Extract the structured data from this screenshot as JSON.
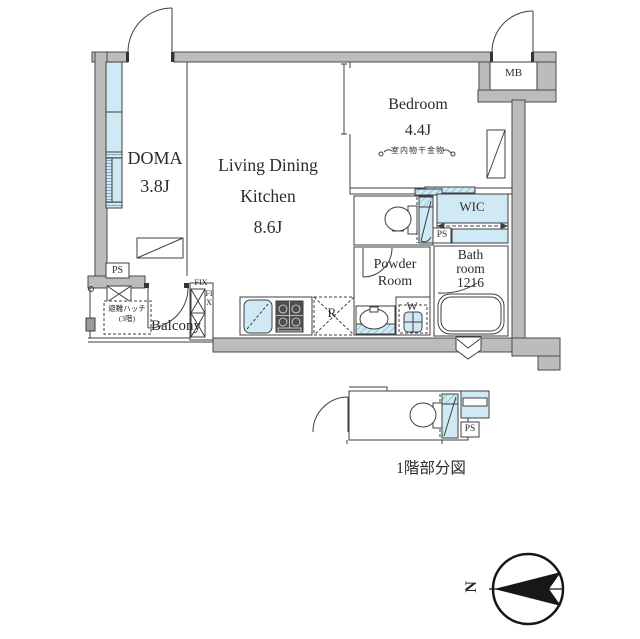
{
  "rooms": {
    "ldk": {
      "line1": "Living Dining",
      "line2": "Kitchen",
      "size": "8.6J"
    },
    "doma": {
      "name": "DOMA",
      "size": "3.8J"
    },
    "bedroom": {
      "name": "Bedroom",
      "size": "4.4J",
      "note": "室内物干金物"
    },
    "wic": {
      "name": "WIC"
    },
    "powder_room": {
      "line1": "Powder",
      "line2": "Room"
    },
    "bathroom": {
      "line1": "Bath",
      "line2": "room",
      "line3": "1216"
    },
    "balcony": {
      "name": "Balcony"
    },
    "meter_box": {
      "name": "MB"
    }
  },
  "fixtures": {
    "refrigerator": "R",
    "washer": "W",
    "pipe_space": "PS",
    "fixed_window": "FIX",
    "evacuation_hatch_line1": "避難ハッチ",
    "evacuation_hatch_line2": "(3階)"
  },
  "captions": {
    "first_floor_partial": "1階部分図",
    "compass_north": "N"
  },
  "colors": {
    "wall": "#bcbcbc",
    "glass": "#cfeaf4",
    "line": "#3f3f3f",
    "stove": "#4f4f4f",
    "compass": "#171717"
  }
}
